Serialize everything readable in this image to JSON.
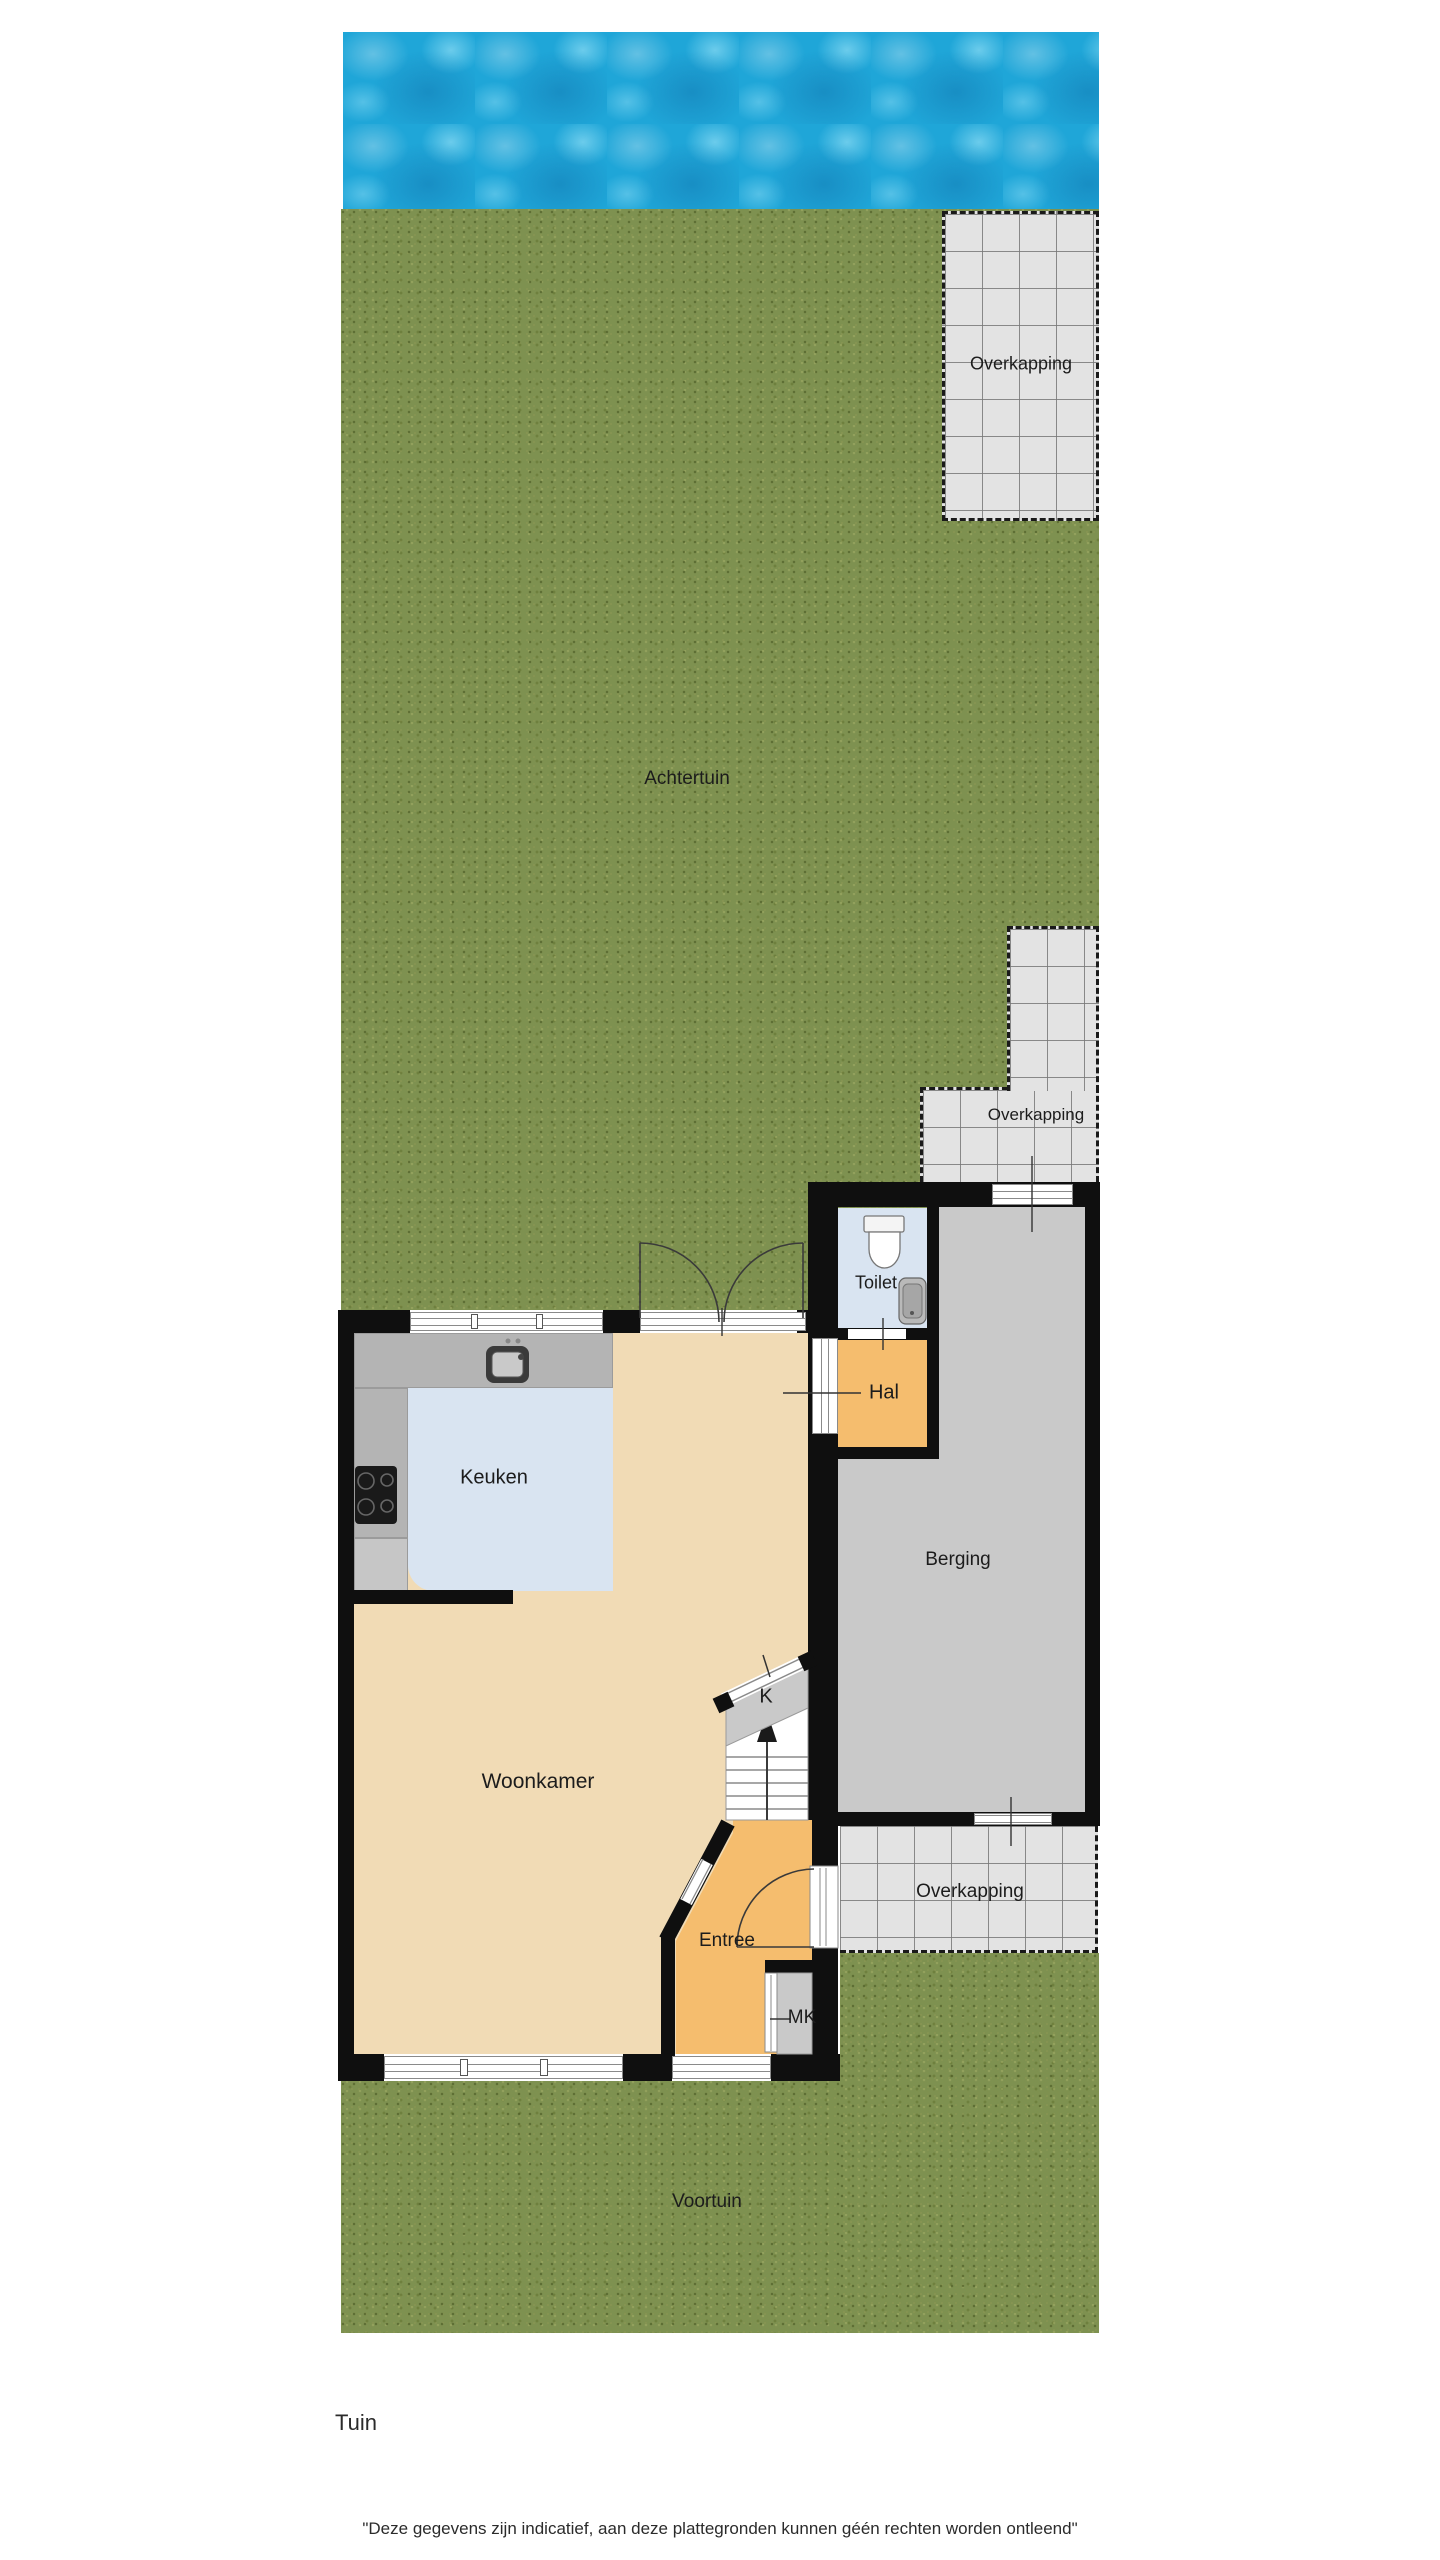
{
  "page_title": "Tuin",
  "plan": {
    "labels": {
      "achtertuin": "Achtertuin",
      "voortuin": "Voortuin",
      "overkapping_top": "Overkapping",
      "overkapping_mid": "Overkapping",
      "overkapping_bottom": "Overkapping",
      "toilet": "Toilet",
      "hal": "Hal",
      "keuken": "Keuken",
      "berging": "Berging",
      "woonkamer": "Woonkamer",
      "stairs": "K",
      "entree": "Entree",
      "meterkast": "MK"
    },
    "colors": {
      "water": "#1fa6d8",
      "grass": "#7e9150",
      "tile": "#e3e3e3",
      "wall": "#0f0f0f",
      "living_floor": "#f1dbb5",
      "hall_floor": "#f5bd6e",
      "kitchen_floor": "#d9e4f1",
      "storage_floor": "#c9c9c9"
    }
  },
  "footer": {
    "floor_label": "Tuin",
    "disclaimer": "\"Deze gegevens zijn indicatief, aan deze plattegronden kunnen géén rechten worden ontleend\""
  }
}
